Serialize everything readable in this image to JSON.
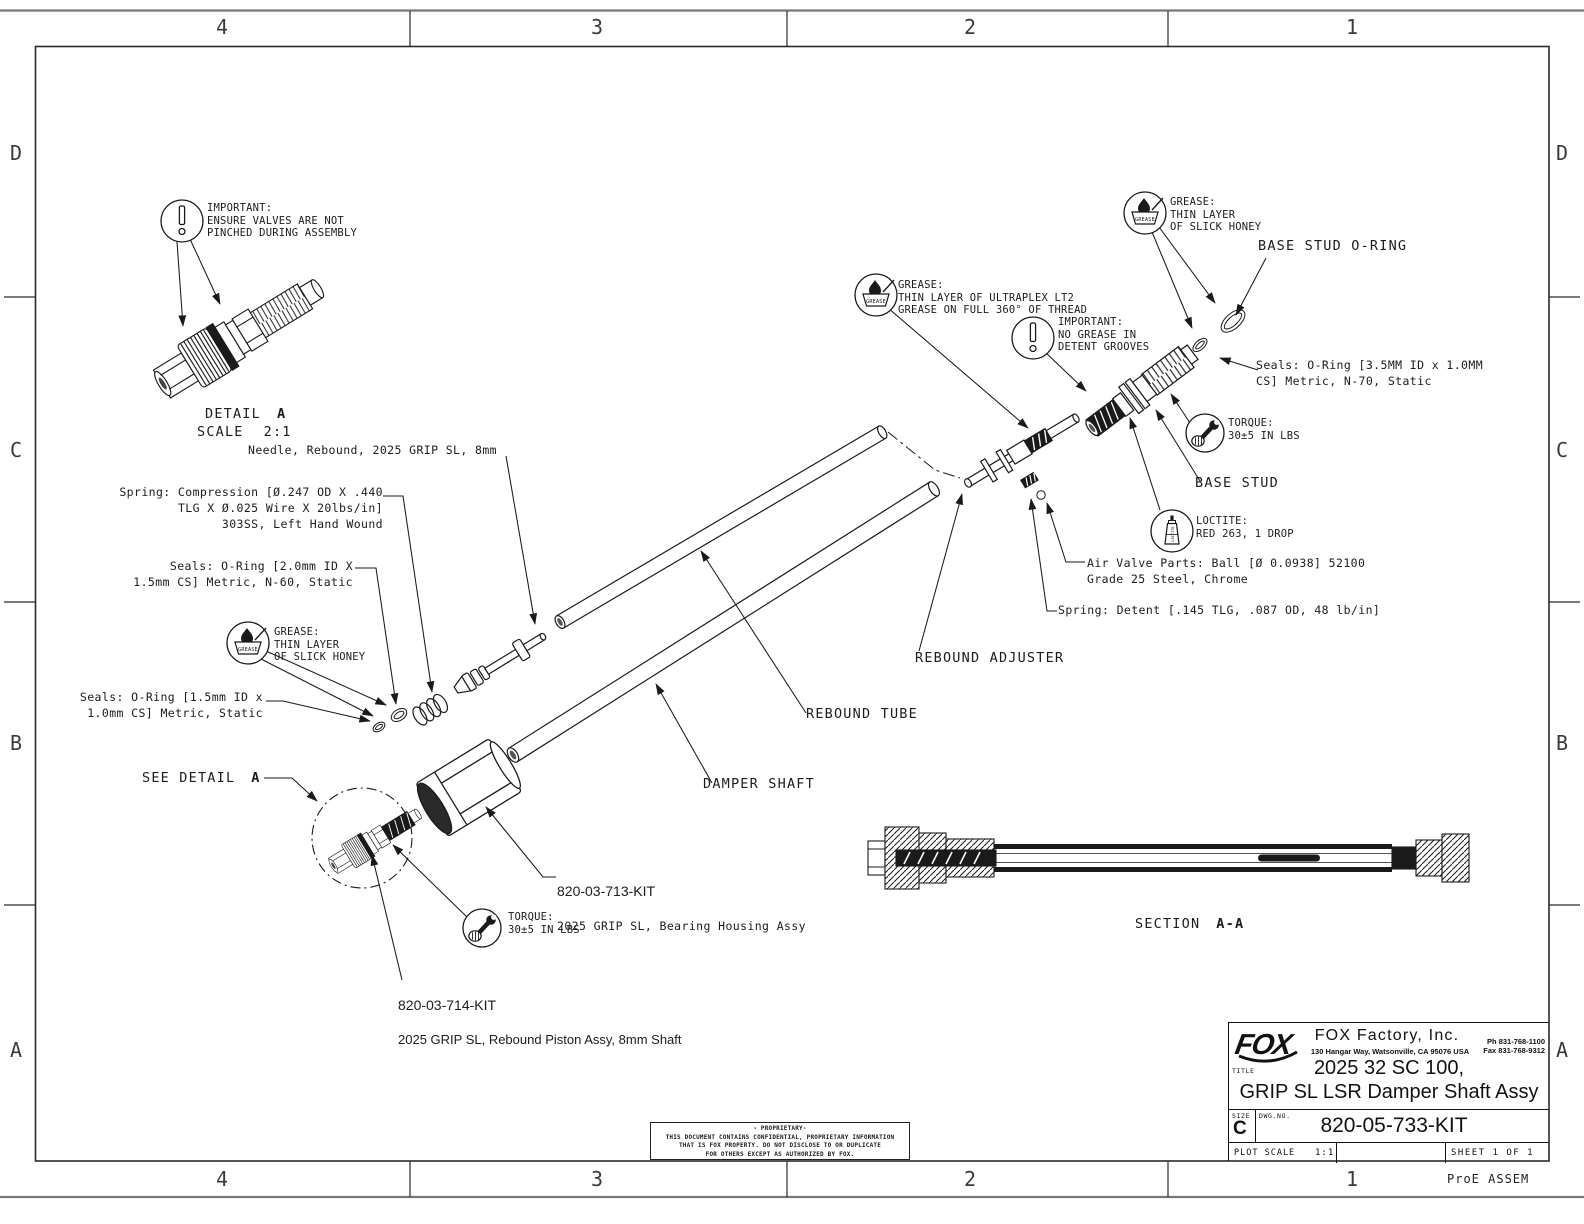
{
  "sheet": {
    "grid_cols": [
      "4",
      "3",
      "2",
      "1"
    ],
    "grid_rows": [
      "D",
      "C",
      "B",
      "A"
    ],
    "footer_note": "ProE ASSEM",
    "colors": {
      "ink": "#1a1a1a",
      "paper": "#ffffff",
      "frame_gray": "#787878"
    }
  },
  "icons": {
    "grease_label": "GREASE",
    "loctite_label": "LOCTITE"
  },
  "views": {
    "detail": {
      "label": "DETAIL",
      "ref": "A",
      "scale_label": "SCALE",
      "scale_value": "2:1"
    },
    "see_detail": {
      "label": "SEE DETAIL",
      "ref": "A"
    },
    "section": {
      "label": "SECTION",
      "ref": "A-A"
    }
  },
  "callouts": {
    "important_assembly": "IMPORTANT:\nENSURE VALVES ARE NOT\nPINCHED DURING ASSEMBLY",
    "needle": "Needle, Rebound, 2025 GRIP SL, 8mm",
    "spring_compression": "Spring: Compression [Ø.247 OD X .440\nTLG X Ø.025 Wire X 20lbs/in]\n303SS, Left Hand Wound",
    "seals_oring_2mm": "Seals: O-Ring [2.0mm ID X\n1.5mm CS] Metric, N-60, Static",
    "grease_slick_left": "GREASE:\nTHIN LAYER\nOF SLICK HONEY",
    "seals_oring_15mm": "Seals: O-Ring [1.5mm ID x\n1.0mm CS] Metric, Static",
    "torque_left": "TORQUE:\n30±5 IN LBS",
    "kit_713_number": "820-03-713-KIT",
    "kit_713_desc": "2025 GRIP SL, Bearing Housing Assy",
    "kit_714_number": "820-03-714-KIT",
    "kit_714_desc": "2025 GRIP SL, Rebound Piston Assy, 8mm Shaft",
    "damper_shaft": "DAMPER SHAFT",
    "rebound_tube": "REBOUND TUBE",
    "rebound_adjuster": "REBOUND ADJUSTER",
    "grease_ultraplex": "GREASE:\nTHIN LAYER OF ULTRAPLEX LT2\nGREASE ON FULL 360° OF THREAD",
    "important_detent": "IMPORTANT:\nNO GREASE IN\nDETENT GROOVES",
    "grease_slick_right": "GREASE:\nTHIN LAYER\nOF SLICK HONEY",
    "base_stud_oring": "BASE STUD O-RING",
    "seals_oring_35mm": "Seals: O-Ring [3.5MM ID x 1.0MM\nCS] Metric, N-70, Static",
    "torque_right": "TORQUE:\n30±5 IN LBS",
    "base_stud": "BASE STUD",
    "loctite": "LOCTITE:\nRED 263, 1 DROP",
    "air_valve": "Air Valve Parts: Ball [Ø 0.0938] 52100\nGrade 25 Steel, Chrome",
    "spring_detent": "Spring: Detent [.145 TLG, .087 OD, 48 lb/in]"
  },
  "title_block": {
    "logo_text": "FOX",
    "company": "FOX Factory, Inc.",
    "address": "130 Hangar Way, Watsonville, CA 95076 USA",
    "phone": "Ph 831-768-1100",
    "fax": "Fax 831-768-9312",
    "title_label": "TITLE",
    "title_line1": "2025 32 SC 100,",
    "title_line2": "GRIP SL LSR Damper Shaft Assy",
    "size_label": "SIZE",
    "size_value": "C",
    "dwg_label": "DWG.NO.",
    "dwg_number": "820-05-733-KIT",
    "plot_scale_label": "PLOT SCALE",
    "plot_scale_value": "1:1",
    "sheet_label": "SHEET 1 OF 1"
  },
  "proprietary": {
    "lines": [
      "- PROPRIETARY-",
      "THIS DOCUMENT CONTAINS CONFIDENTIAL, PROPRIETARY INFORMATION",
      "THAT IS FOX PROPERTY.  DO NOT DISCLOSE TO OR DUPLICATE",
      "FOR OTHERS EXCEPT AS AUTHORIZED BY FOX."
    ]
  }
}
